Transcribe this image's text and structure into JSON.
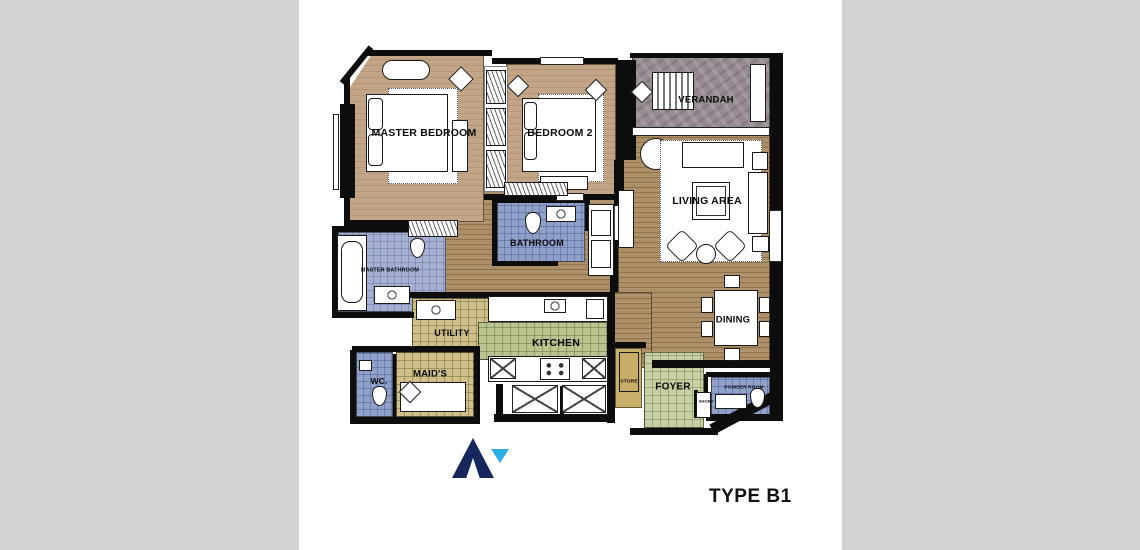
{
  "canvas": {
    "background_color": "#d2d2d2",
    "sheet_color": "#ffffff"
  },
  "title": {
    "type_label": "TYPE B1"
  },
  "logo": {
    "primary_color": "#16275b",
    "accent_color": "#2aaee3"
  },
  "rooms": {
    "master_bedroom": {
      "label": "MASTER BEDROOM"
    },
    "bedroom_2": {
      "label": "BEDROOM 2"
    },
    "verandah": {
      "label": "VERANDAH"
    },
    "living_area": {
      "label": "LIVING AREA"
    },
    "dining": {
      "label": "DINING"
    },
    "bathroom": {
      "label": "BATHROOM"
    },
    "master_bathroom": {
      "label": "MASTER BATHROOM"
    },
    "utility": {
      "label": "UTILITY"
    },
    "kitchen": {
      "label": "KITCHEN"
    },
    "wc": {
      "label": "WC."
    },
    "maids": {
      "label": "MAID'S"
    },
    "store": {
      "label": "STORE"
    },
    "foyer": {
      "label": "FOYER"
    },
    "shoes": {
      "label": "SHOES"
    },
    "powder_room": {
      "label": "POWDER ROOM"
    }
  },
  "palette": {
    "wall": "#0d0d0d",
    "wood_floor": "#ac8f66",
    "bedroom_floor": "#c2a586",
    "verandah_floor": "#978b93",
    "bathroom_floor": "#8fa0c9",
    "master_bathroom_floor": "#a6b0d2",
    "kitchen_floor": "#b9c48f",
    "utility_maid_floor": "#cfc08b",
    "foyer_floor": "#c7d1a5",
    "store_floor": "#c9b06b"
  }
}
